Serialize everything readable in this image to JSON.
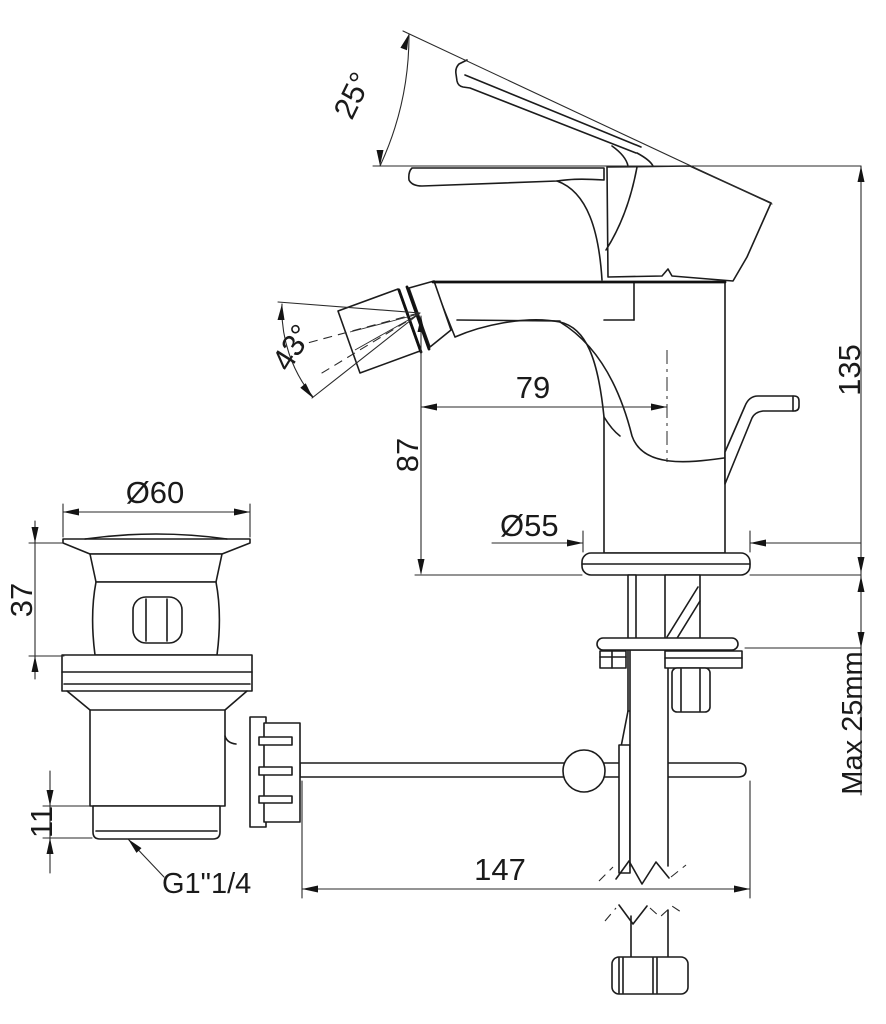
{
  "drawing": {
    "title": "Bidet mixer with pop-up waste — dimensional drawing",
    "line_color": "#1c1c1c",
    "background": "#ffffff",
    "labels": {
      "handle_angle": "25°",
      "spray_angle": "43°",
      "spout_reach": "79",
      "spout_height": "87",
      "total_height": "135",
      "deck_thickness": "Max 25mm",
      "base_diameter": "Ø55",
      "waste_diameter": "Ø60",
      "waste_height": "37",
      "thread_height": "11",
      "thread_size": "G1\"1/4",
      "rod_length": "147"
    }
  }
}
